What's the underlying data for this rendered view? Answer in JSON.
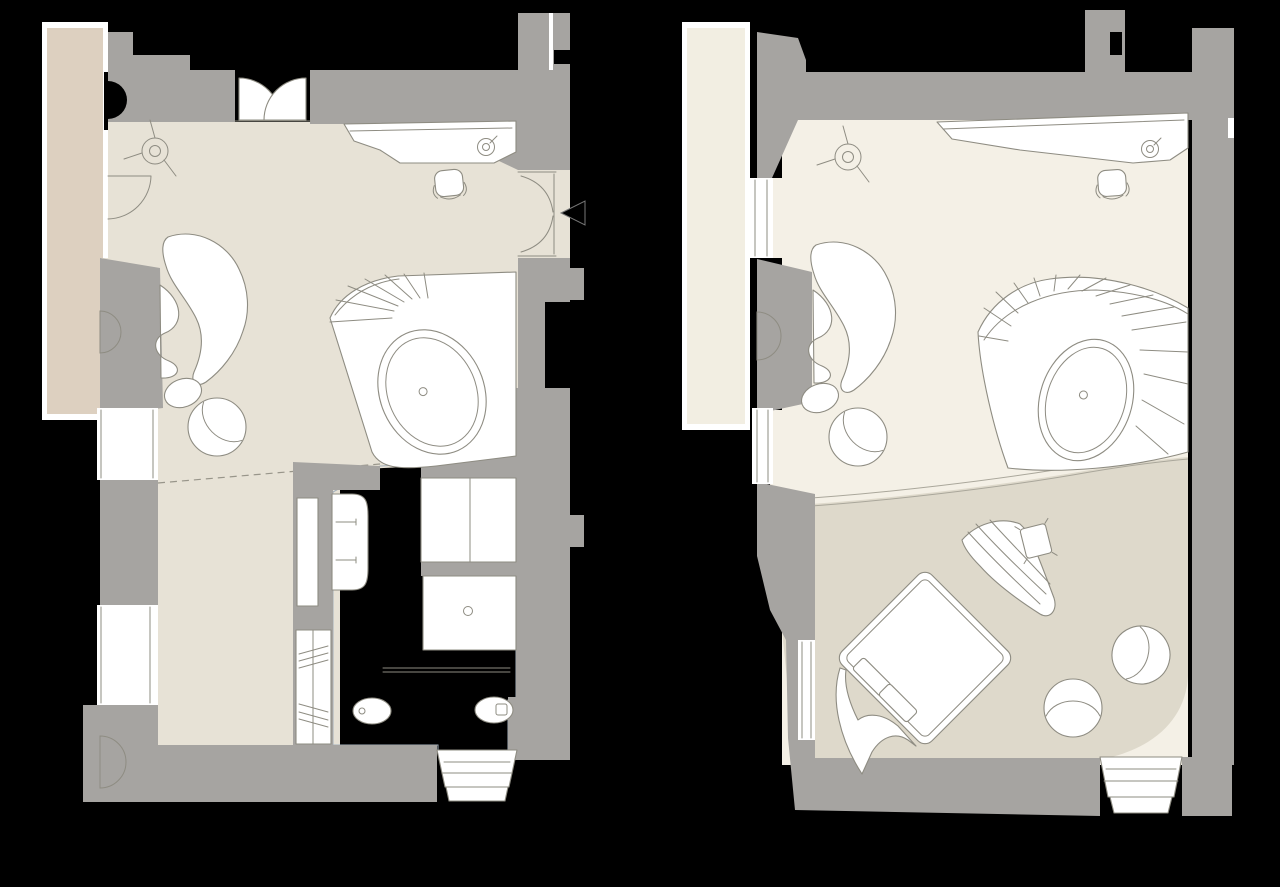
{
  "title": "Duplex suite floor plans (lower and upper level)",
  "canvas": {
    "width": 1280,
    "height": 887
  },
  "palette": {
    "background": "#000000",
    "wall": "#a6a4a1",
    "floor_main": "#e7e2d6",
    "floor_bath": "#d8e6f2",
    "terrace_lower": "#ddd0c0",
    "terrace_upper": "#f2eee2",
    "floor_upper": "#f4f0e6",
    "rug": "#ded9cb",
    "furniture_fill": "#ffffff",
    "line": "#8e8c82",
    "entry_arrow": "#000000"
  },
  "plans": [
    {
      "id": "lower-level",
      "position": "left",
      "rooms": [
        "living-area",
        "bathroom",
        "dressing-area",
        "terrace"
      ],
      "elements": [
        "double-entry-doors",
        "ceiling-fan-symbol",
        "desk",
        "desk-lamp",
        "desk-chair",
        "entry-door",
        "entry-arrow-marker",
        "curved-sofa",
        "oval-stool",
        "swivel-armchair",
        "spiral-stair-steps",
        "freestanding-bathtub",
        "vanity-basin",
        "tall-cabinet",
        "storage-cabinet",
        "shower",
        "glass-screen",
        "toilet",
        "bidet",
        "wardrobe-with-rail",
        "bay-window",
        "curtain",
        "wall-niche",
        "windows",
        "side-door"
      ]
    },
    {
      "id": "upper-level",
      "position": "right",
      "rooms": [
        "lounge-area",
        "sleeping-area",
        "terrace"
      ],
      "elements": [
        "ceiling-fan-symbol",
        "desk",
        "desk-lamp",
        "desk-chair",
        "curved-sofa",
        "oval-stool",
        "swivel-armchair",
        "spiral-stair-steps",
        "freestanding-bathtub",
        "double-bed",
        "pillows",
        "throw-blanket",
        "chaise-longue",
        "side-table",
        "round-armchair-1",
        "round-armchair-2",
        "area-rug",
        "bay-window",
        "curtain",
        "wall-niche",
        "windows"
      ]
    }
  ]
}
